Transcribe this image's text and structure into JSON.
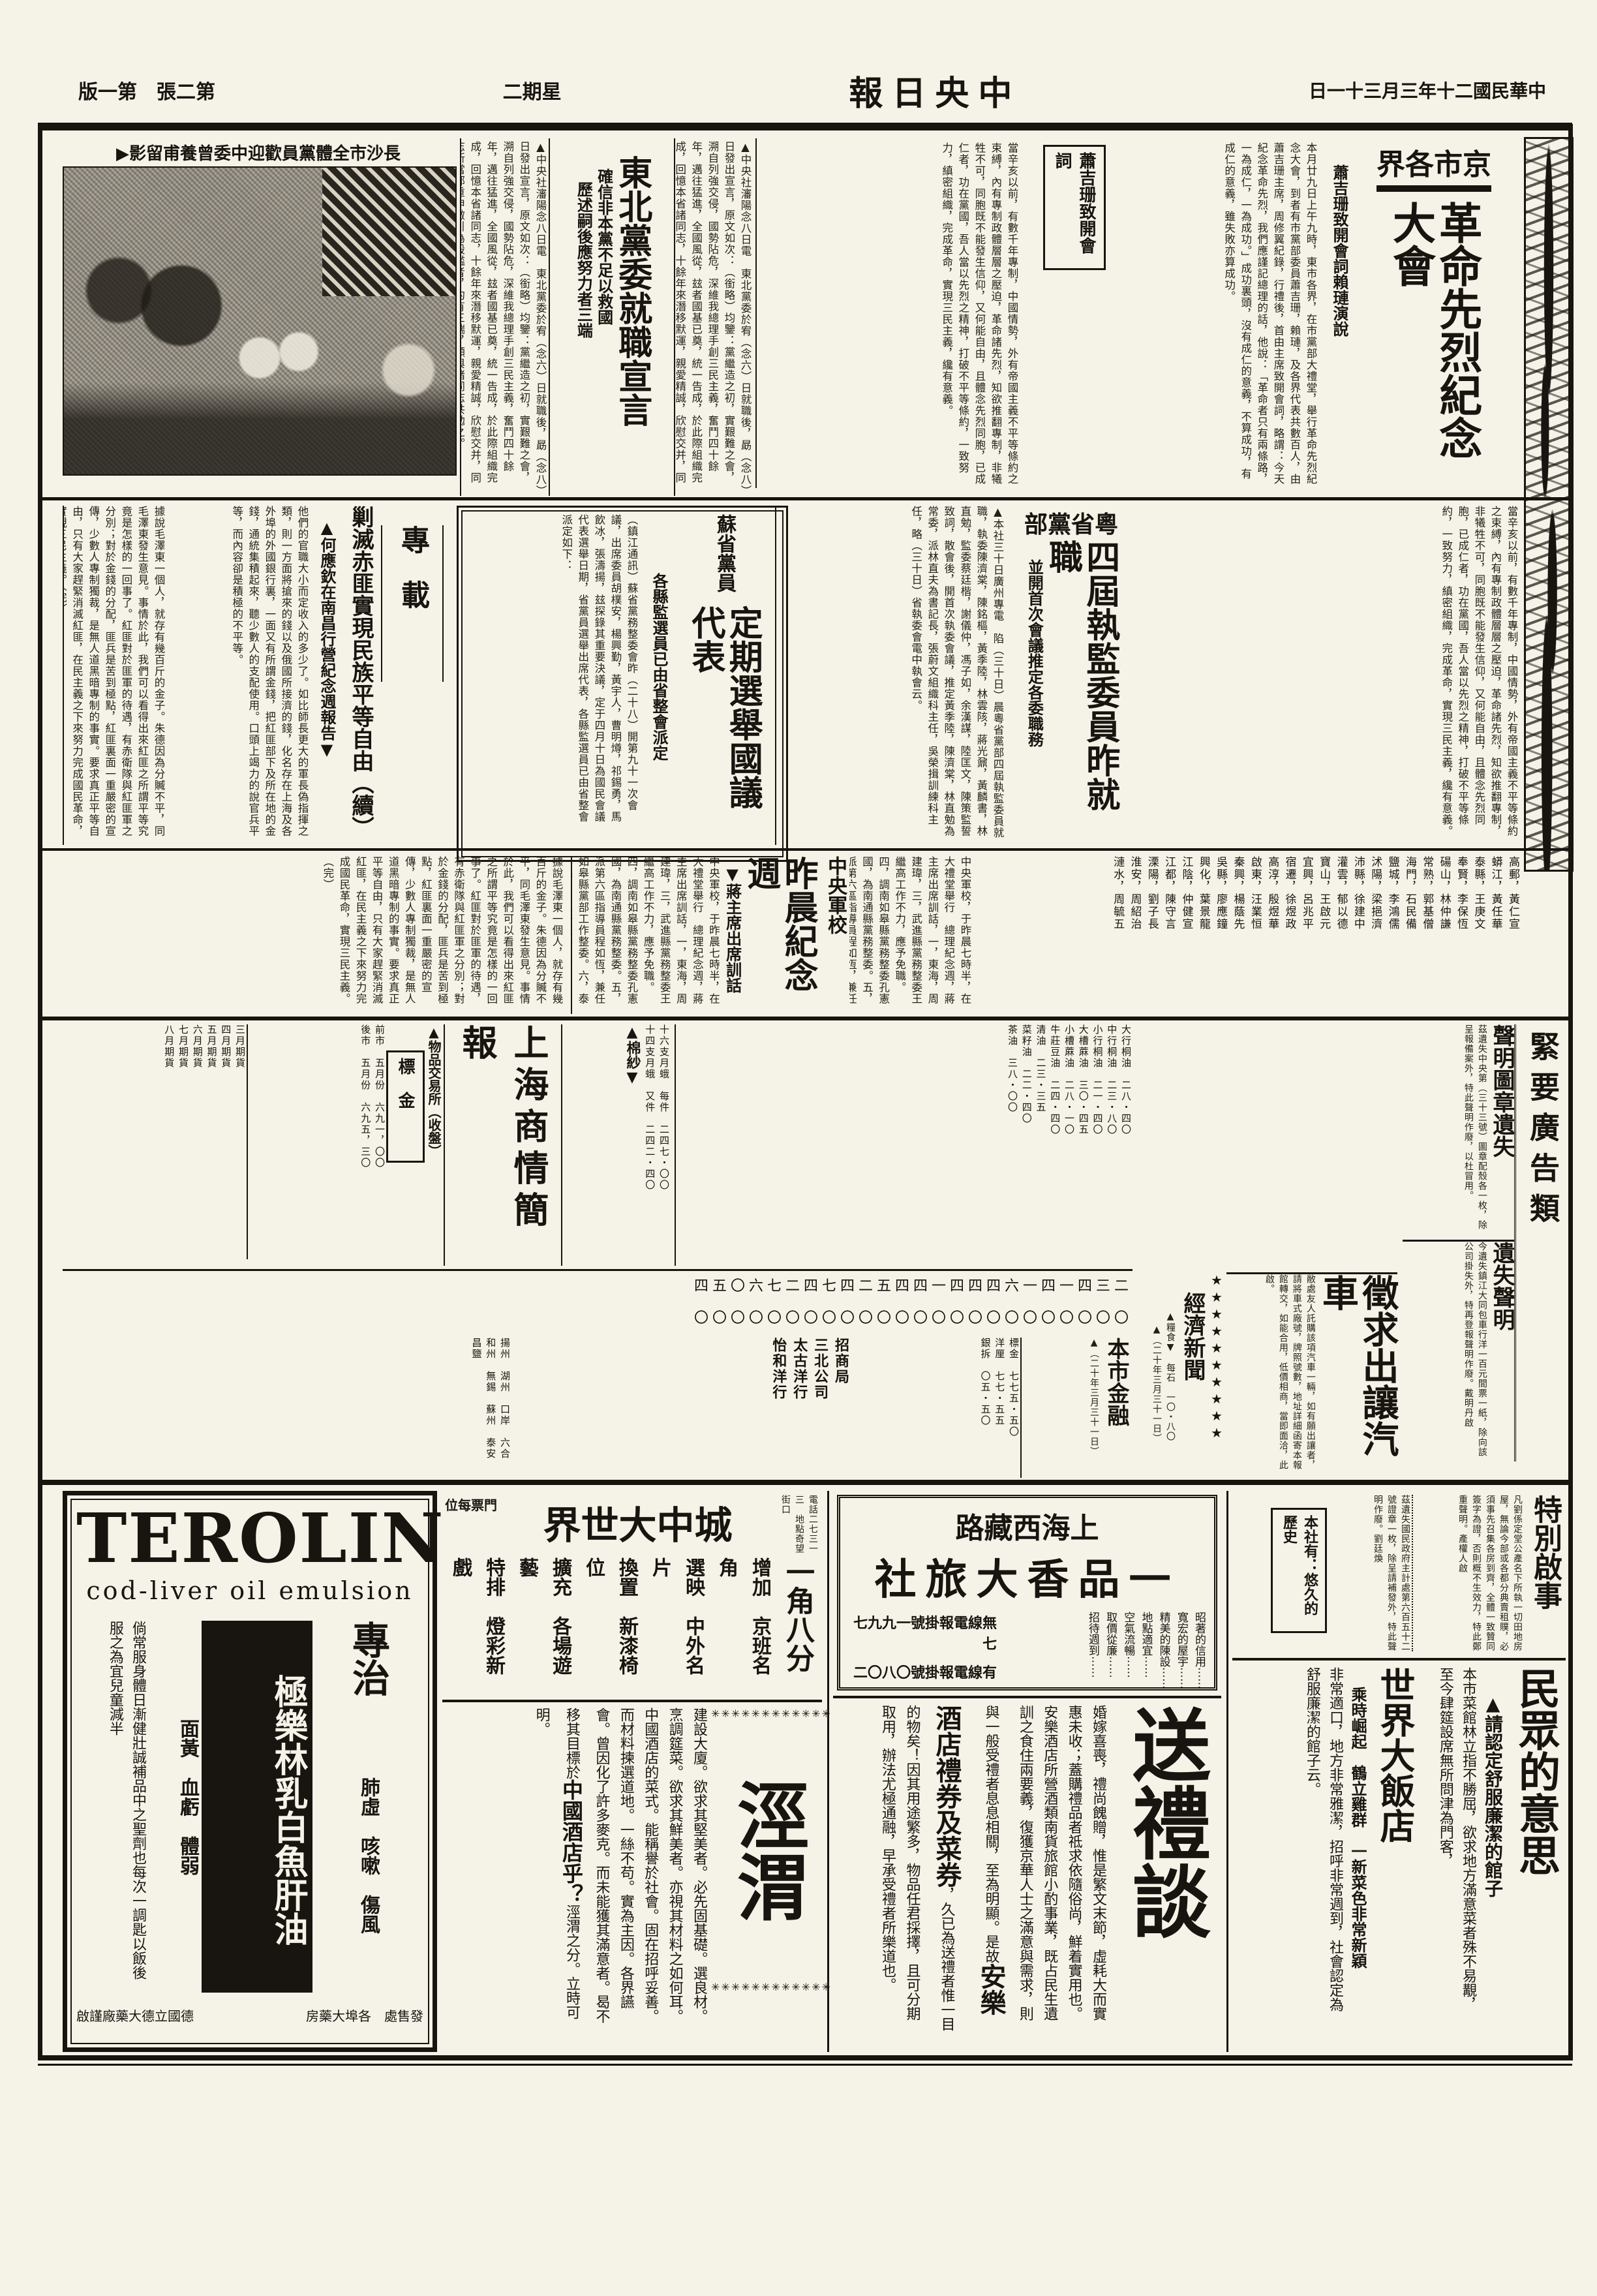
{
  "masthead": {
    "date": "中華民國二十年三月三十一日",
    "title": "中央日報",
    "weekday": "星期二",
    "edition": "第二張　第一版"
  },
  "photo": {
    "caption": "長沙市全體黨員歡迎中委曾養甫留影▶"
  },
  "articles": {
    "jingshi": {
      "kicker": "京市各界",
      "headline": "革命先烈紀念大會",
      "subhead": "蕭吉珊致開會詞賴璉演說",
      "box_label": "蕭吉珊致開會詞",
      "body": "本月廿九日上午九時，東市各界，在市黨部大禮堂，舉行革命先烈紀念大會，到者有市黨部委員蕭吉珊，賴璉，及各界代表共數百人，由蕭吉珊主席，周修翼紀錄，行禮後，首由主席致開會詞，略謂：今天紀念革命先烈，我們應謹記總理的話，他說：「革命者只有兩條路，一為成仁，一為成功。」成功裏頭，沒有成仁的意義，不算成功，有成仁的意義，雖失敗亦算成功。",
      "body2": "當辛亥以前，有數千年專制，中國情勢，外有帝國主義不平等條約之束縛，內有專制政體層層之壓迫，革命諸先烈，知欲推翻專制，非犧牲不可，同胞既不能發生信仰，又何能自由，且體念先烈同胞，已成仁者，功在黨國，吾人當以先烈之精神，打破不平等條約，一致努力，縝密組織，完成革命，實現三民主義，纔有意義。"
    },
    "dongbei": {
      "headline": "東北黨委就職宣言",
      "subhead1": "確信非本黨不足以救國",
      "subhead2": "歷述嗣後應努力者三端",
      "body": "▲中央社瀋陽念八日電　東北黨委於宥（念六）日就職後，勗（念八）日發出宣言，原文如次：（銜略）均鑒：黨繼造之初，實艱難之會，溯自列強交侵，國勢阽危，深維我總理手創三民主義，奮鬥四十餘年，邁往猛進，全國風從，玆者國基已奠，統一告成，於此際組織完成，回憶本省諸同志，十餘年來潛移默運，親愛精誠，欣慰交并，同志所當鄭重申儆引為殷鑑者，約有三端，願與諸同志共勉之。"
    },
    "yue": {
      "kicker": "粵省黨部",
      "headline": "四屆執監委員昨就職",
      "subhead": "並開首次會議推定各委職務",
      "body": "▲本社三十日廣州專電　陷（三十日）晨粵省黨部四屆執監委員就職，執委陳濟棠，陳銘樞，黃季陸，林雲陔，蔣光鼐，黃麟書，林直勉，監委蔡廷楷，謝儀仲，馮子如，余漢謀，陸匡文，陳策監誓致詞，散會後，開首次執委會議，推定黃季陸，陳濟棠，林直勉為常委，派林直夫為書記長，張蔚文組織科主任，吳榮揖訓練科主任，略（三十日）省執委會電中執會云。"
    },
    "su": {
      "kicker": "蘇省黨員",
      "headline": "定期選舉國議代表",
      "subhead": "各縣監選員已由省整會派定",
      "body": "（鎮江通訊）蘇省黨務整委會昨（二十八）開第九十一次會議，出席委員胡樸安，楊興勤，黃宇人，曹明燇，祁錫勇，馬飲冰，張濤揚，玆探錄其重要決議，定于四月十日為國民會議代表選舉日期，省黨員選舉出席代表，各縣監選員已由省整會派定如下："
    },
    "names_pairs": [
      "高郵，黃仁宣",
      "蟒江，黃任華",
      "泰縣，王庚文",
      "奉賢，李保恆",
      "碭山，林仲謙",
      "常熟，郭基僧",
      "海門，石民備",
      "鹽城，李鴻儒",
      "沭陽，梁挹濟",
      "沛縣，徐建中",
      "灌雲，郁以德",
      "寶山，王啟元",
      "宜興，呂兆平",
      "宿遷，徐煜政",
      "高淳，殷煜華",
      "啟東，汪業恒",
      "秦興，楊蔭先",
      "吳縣，廖應鐘",
      "興化，葉景龍",
      "江陰，仲健宣",
      "江都，陳守言",
      "溧陽，劉子長",
      "淮安，周紹治",
      "漣水，周毓五",
      "泗陽，恭廷昌",
      "青浦，廖厚徽",
      "武進，黃霈",
      "南匯，甘聖會",
      "南通，潘聖瑞",
      "松江，王德昌",
      "嘉定，王吉峻",
      "蕭縣，尹行之",
      "邳縣，魏次曾",
      "太倉，謝慶純",
      "上海，吳保曾",
      "丹陽，呂元白"
    ],
    "zhuanzai": {
      "section": "專載",
      "headline": "剿滅赤匪實現民族平等自由（續）",
      "subhead": "▲何應欽在南昌行營紀念週報告▼",
      "body": "他們的官職大小而定收入的多少了。如比師長更大的軍長偽指揮之類，則一方面將搶來的錢以及俄國所接濟的錢，化名存在上海及各外埠的外國銀行裏，一面又有所謂金錢，把紅匪部下及所在地的金錢，通統集積起來，聽少數人的支配使用。口頭上竭力的說官兵平等，而內容卻是積極的不平等。",
      "body2": "據說毛澤東一個人，就存有幾百斤的金子。朱德因為分贓不平，同毛澤東發生意見。事情於此，我們可以看得出來紅匪之所謂平等究竟是怎樣的一回事了。紅匪對於匪軍的待遇，有赤衛隊與紅匪軍之分別；對於金錢的分配，匪兵是苦到極點，紅匪裏面一重嚴密的宣傳，少數人專制獨裁，是無人道黑暗專制的事實。要求真正平等自由，只有大家趕緊消滅紅匪，在民主義之下來努力完成國民革命，實現三民主義。（完）"
    },
    "junxiao": {
      "kicker": "中央軍校",
      "headline": "昨晨紀念週",
      "subhead": "▼蔣主席出席訓話",
      "body": "中央軍校，于昨晨七時半，在大禮堂舉行　總理紀念週，蔣主席出席訓話，一，東海，周建瑋，三，武進縣黨務整委王繼高工作不力，應予免職。四，調南如皋縣黨務整委孔憲國，為南通縣黨務整委。五，派第六區指導員程如恆，兼任如皋縣黨部工作整委。六，泰興縣黨部工務整委，應予嘉奬。七，江蘇通訊社，于本月底撤銷。"
    }
  },
  "classifieds": {
    "header": "緊要廣告類",
    "seal_lost_headline": "聲明圖章遺失",
    "seal_lost_body": "茲遺失中央第（三十三號）圖章配殼各一枚，除呈報備案外，特此聲明作廢，以杜冒用。",
    "ticket_lost_headline": "遺失聲明",
    "ticket_lost_body": "今遺失鎮江大同包車行洋一百元間票一紙，除向該公司掛失外，特再登報聲明作廢。戴明丹啟",
    "car_wanted_headline": "徵求出讓汽車",
    "car_wanted_body": "敝處友人託購該項汽車一輛，如有願出讓者，請將車式廠號，牌照號數，地址詳細函寄本報館轉交，如能合用，低價相商，當即面洽，此啟。",
    "econ_header": "經濟新聞",
    "econ_stars": "★★★★★★★★★★",
    "grain_label": "▲糧食▼　每石　一〇・八〇",
    "econ_date": "▲（二十年三月三十一日）"
  },
  "market": {
    "title": "上海商情簡報",
    "exchange_label": "▲物品交易所（收盤）",
    "gold_label": "標　金",
    "gold_rows": [
      "前市　五月份　六九一，〇〇",
      "後市　五月份　六九五，三〇"
    ],
    "months_rows": [
      "三月期貨",
      "四月期貨",
      "五月期貨",
      "六月期貨",
      "七月期貨",
      "八月期貨"
    ],
    "months_nums": "九九一，〇〇　九九五，三〇　七七五五　七七〇〇　五五〇〇　五五",
    "commodities": [
      "大行桐油　二八・四〇",
      "中行桐油　二三・八〇",
      "小行桐油　二一・四〇",
      "大槽蔴油　三〇・四五",
      "小槽蔴油　二八・一〇",
      "牛莊豆油　二四・四〇",
      "清油　二三・三五",
      "菜籽油　二二・四〇",
      "茶油　三八・〇〇"
    ],
    "yarn_label": "▲棉紗▼",
    "yarn_rows": [
      "十六支月蛾　每件　二四七・〇〇",
      "十四支月蛾　又件　二四二・四〇"
    ],
    "num_row1": "〇〇〇〇〇〇〇〇〇〇〇〇〇〇〇〇〇〇〇〇〇〇〇〇",
    "num_row2": "二三四一四一六四四四一四四五二四七四二七六〇五四",
    "companies": [
      "招商局",
      "三北公司",
      "太古洋行",
      "怡和洋行"
    ],
    "routes": "揚州　湖州　口岸　六合　和州　無錫　蘇州　泰安　昌鹽",
    "finance_header": "本市金融",
    "finance_date": "▲（二十年三月三十一日）",
    "finance_rows": [
      "標金　七七五・五〇",
      "洋厘　七七・五五",
      "銀拆　〇五・五〇"
    ]
  },
  "ads": {
    "terolin": {
      "brand": "TEROLIN",
      "sub": "cod-liver oil emulsion",
      "product": "極樂林乳白魚肝油",
      "claim": "專治",
      "ailments1": "肺虛　咳嗽　傷風",
      "ailments2": "面黃　血虧　體弱",
      "usage": "倘常服身體日漸健壯誠補品中之聖劑也每次一調匙以飯後服之為宜兒童減半",
      "seller": "發售處　各埠大藥房",
      "maker": "德國立德大藥廠謹啟"
    },
    "world": {
      "name": "城中大世界",
      "addr": "地點奇望街口",
      "phone": "電話二七三一三",
      "ticket": "門票每位",
      "price": "一角八分",
      "features": [
        "增加　京班名角",
        "選映　中外名片",
        "換置　新漆椅位",
        "擴充　各場遊藝",
        "特排　燈彩新戲",
        "新編　白話新劇"
      ]
    },
    "jingwei": {
      "big": "涇渭",
      "stars": "✳✳✳✳✳✳✳✳✳✳✳✳",
      "body": "建設大廈。欲求其堅美者。必先固基礎。選良材。烹調筵菜。欲求其鮮美者。亦視其材料之如何耳。中國酒店的菜式。能稱譽於社會。固在招呼妥善。而材料揀選道地。一絲不苟。實為主因。各界讌會。曾因化了許多麥克。而未能獲其滿意者。曷不移其目標於",
      "brand": "中國酒店乎？",
      "tail": "涇渭之分。立時可明。"
    },
    "yipinxiang": {
      "location": "上海西藏路",
      "name": "一品香大旅社",
      "features": [
        "昭著的信用⋯⋯",
        "寬宏的屋宇⋯⋯",
        "精美的陳設⋯⋯",
        "地點適宜⋯⋯",
        "空氣流暢⋯⋯",
        "取價從廉⋯⋯",
        "招待週到⋯⋯"
      ],
      "radio": "無線電報掛號一九九七七",
      "wire": "有線電報掛號〇八〇二"
    },
    "songli": {
      "title": "送禮談",
      "body1": "婚嫁喜喪，禮尚餽贈，惟是繁文末節，虛耗大而實惠未收；蓋購禮品者祗求依隨俗尚，鮮着實用也。",
      "body2": "安樂酒店所營酒類南貨旅館小酌事業，既占民生遺訓之食住兩要義，復獲京華人士之滿意與需求，則與一般受禮者息息相關，至為明顯。是故",
      "highlight": "安樂酒店禮券及菜券",
      "body3": "，久已為送禮者惟一目的物矣！因其用途繁多，物品任君採擇，且可分期取用，辦法尤極通融，早承受禮者所樂道也。"
    },
    "special": {
      "header": "特別啟事",
      "body1": "凡劉係定堂公產名下所執一切田地房屋，無論今部或各都分典賣租贌，必須事先召集各房到齊，全體一致贊同簽字為證，否則概不生效力，特此鄭重聲明。產權人啟",
      "body2": "茲遺失國民政府主計處第六百五十二號證章一枚，除呈請補發外，特此聲明作廢。劉廷煥",
      "box": "本社有：悠久的歷史"
    },
    "minzhong": {
      "title": "民眾的意思",
      "subhead": "▲請認定舒服廉潔的館子",
      "body": "本市菜館林立指不勝屈，欲求地方滿意菜者殊不易覯，至今肆筵設席無所問津為門客，",
      "hotel": "世界大飯店",
      "hotel_sub": "乘時崛起　鶴立雞群　一新菜色非常新穎",
      "hotel_body": "非常適口，地方非常雅潔，招呼非常週到，社會認定為舒服廉潔的館子云。"
    }
  }
}
